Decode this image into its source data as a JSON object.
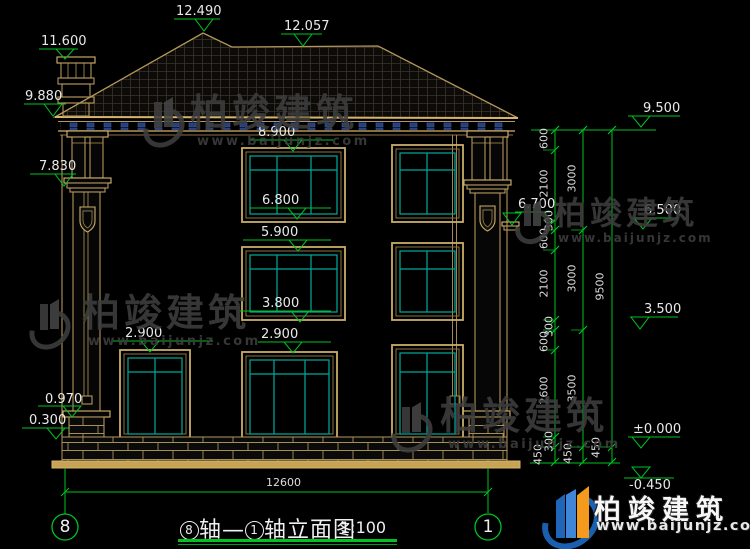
{
  "caption": {
    "axis_start": "8",
    "connector": "轴—",
    "axis_end": "1",
    "text": "轴立面图",
    "scale": "1:100"
  },
  "axes": {
    "left": "8",
    "right": "1"
  },
  "brand": {
    "name": "柏竣建筑",
    "url": "www.baijunjz.com"
  },
  "elevation_marks": {
    "ridge_peak": "12.490",
    "ridge_main": "12.057",
    "chimney_top": "11.600",
    "eave_left": "9.880",
    "capital_left": "7.830",
    "win3_head": "8.900",
    "win3_sill": "6.800",
    "win2_head": "5.900",
    "win2_sill": "3.800",
    "door_head_left": "2.900",
    "door_head_mid": "2.900",
    "pedestal_top": "0.970",
    "plinth_top": "0.300",
    "eave_right": "9.500",
    "belt_right": "6.700",
    "floor3": "6.500",
    "floor2": "3.500",
    "ground": "±0.000",
    "site": "-0.450"
  },
  "dims": {
    "total_width": "12600",
    "chain_inner": [
      "600",
      "2100",
      "300",
      "600",
      "2100",
      "300",
      "600",
      "2600",
      "300",
      "450"
    ],
    "chain_story": [
      "3000",
      "3000",
      "3500",
      "450"
    ],
    "chain_total": [
      "9500",
      "450"
    ]
  }
}
